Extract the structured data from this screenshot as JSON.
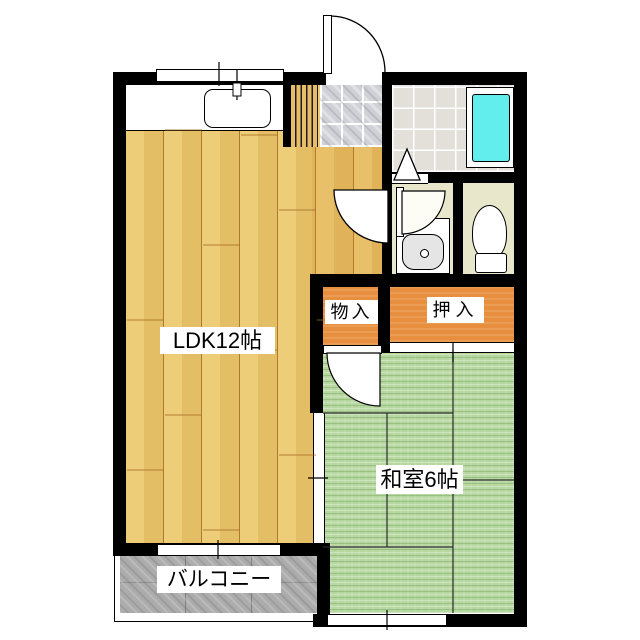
{
  "floorplan": {
    "rooms": {
      "ldk": {
        "label": "LDK12帖"
      },
      "washitsu": {
        "label": "和室6帖"
      },
      "monoiri": {
        "label": "物入"
      },
      "oshiire": {
        "label": "押入"
      },
      "balcony": {
        "label": "バルコニー"
      }
    },
    "colors": {
      "wall": "#000000",
      "wood_floor": "#edc96e",
      "tatami_floor": "#b6d8a0",
      "closet_fill": "#e78f3e",
      "bathtub": "#63eeee",
      "sanitary_floor": "#e9e7cb",
      "bath_tile": "#e3e0da",
      "genkan_tile": "#cfd1d6",
      "balcony_floor": "#acacac",
      "label_background": "#ffffff",
      "label_text": "#000000"
    }
  }
}
